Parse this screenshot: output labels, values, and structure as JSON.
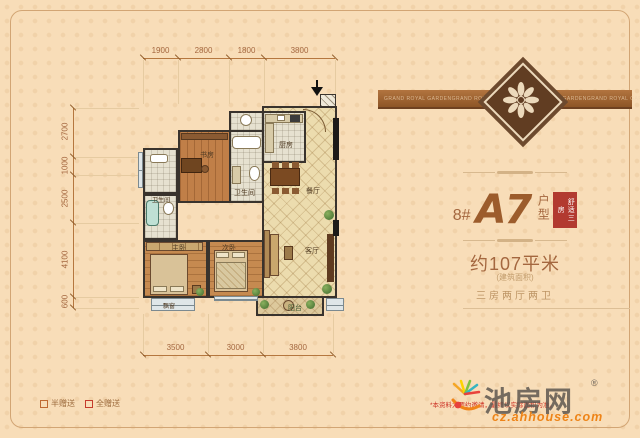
{
  "ribbon": {
    "text": "GRAND ROYAL GARDEN"
  },
  "panel": {
    "unit_number": "8#",
    "unit_code": "A7",
    "unit_type_label": "户型",
    "badge": "舒适三房",
    "area": "约107平米",
    "area_note": "(建筑面积)",
    "rooms_desc": "三房两厅两卫"
  },
  "legend": {
    "half_gift": "半赠送",
    "full_gift": "全赠送"
  },
  "footer": {
    "logo": "池房网",
    "reg": "®",
    "url": "cz.ahhouse.com",
    "disclaimer": "*本资料为要约邀请，最终以实际面积为准。"
  },
  "plan": {
    "rooms": {
      "study": "书房",
      "bath_center": "卫生间",
      "bath_left": "卫生间",
      "kitchen": "厨房",
      "dining": "餐厅",
      "living": "客厅",
      "master": "主卧",
      "second": "次卧",
      "balcony": "阳台",
      "bay_window": "飘窗"
    },
    "dims_top": [
      "1900",
      "2800",
      "1800",
      "3800"
    ],
    "dims_left": [
      "2700",
      "1000",
      "2500",
      "4100",
      "600"
    ],
    "dims_bottom": [
      "3500",
      "3000",
      "3800"
    ]
  },
  "colors": {
    "accent_brown": "#a4673f",
    "badge_red": "#b23a30",
    "url_orange": "#ee8418"
  }
}
